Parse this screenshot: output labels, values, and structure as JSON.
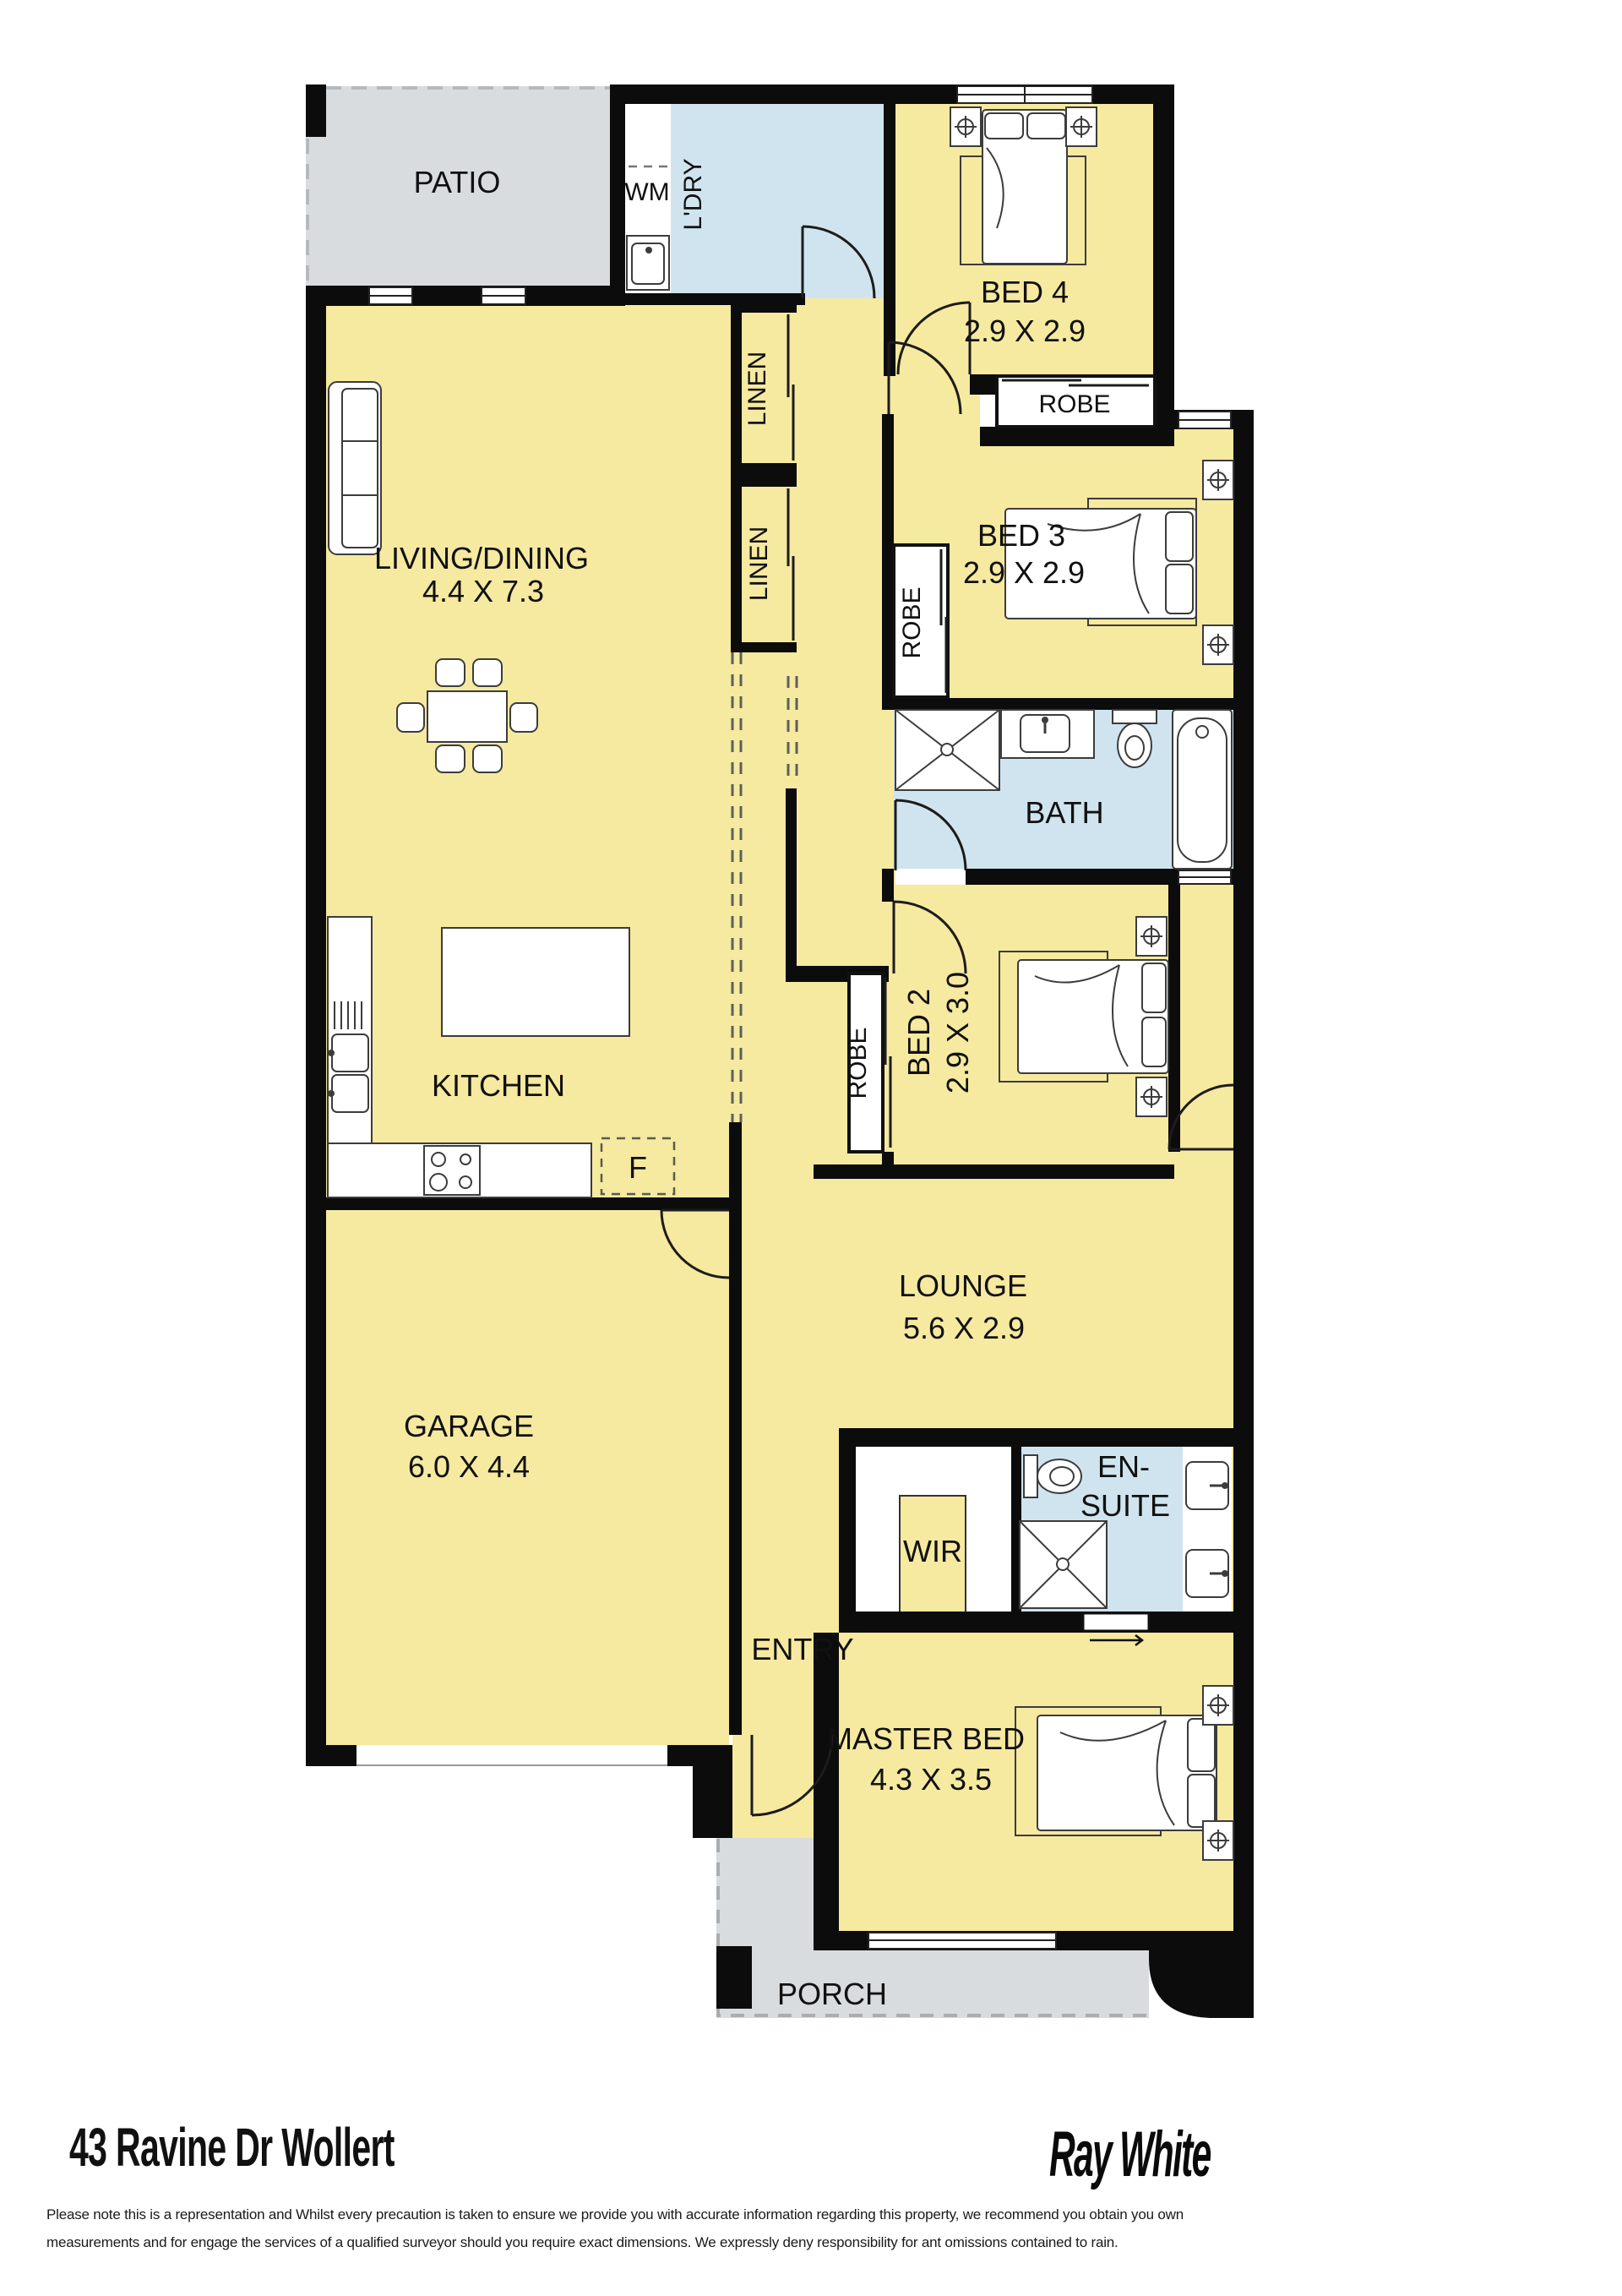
{
  "rooms": {
    "patio": {
      "label": "PATIO"
    },
    "laundry": {
      "name": "L'DRY",
      "wm_label": "WM"
    },
    "bed4": {
      "name": "BED 4",
      "size": "2.9 X 2.9"
    },
    "robe_bed4": {
      "label": "ROBE"
    },
    "linen_top": {
      "label": "LINEN"
    },
    "linen_bottom": {
      "label": "LINEN"
    },
    "bed3": {
      "name": "BED 3",
      "size": "2.9 X 2.9"
    },
    "robe_bed3": {
      "label": "ROBE"
    },
    "bath": {
      "name": "BATH"
    },
    "bed2": {
      "name": "BED 2",
      "size": "2.9 X 3.0"
    },
    "robe_bed2": {
      "label": "ROBE"
    },
    "living": {
      "name": "LIVING/DINING",
      "size": "4.4 X 7.3"
    },
    "kitchen": {
      "name": "KITCHEN",
      "fridge_label": "F"
    },
    "lounge": {
      "name": "LOUNGE",
      "size": "5.6 X 2.9"
    },
    "garage": {
      "name": "GARAGE",
      "size": "6.0 X 4.4"
    },
    "wir": {
      "label": "WIR"
    },
    "ensuite": {
      "line1": "EN-",
      "line2": "SUITE"
    },
    "entry": {
      "label": "ENTRY"
    },
    "master": {
      "name": "MASTER BED",
      "size": "4.3 X 3.5"
    },
    "porch": {
      "label": "PORCH"
    }
  },
  "footer": {
    "address": "43 Ravine Dr Wollert",
    "brand": "Ray White",
    "disclaimer_line1": "Please note this is a representation and Whilst every precaution is taken to ensure we provide you with accurate information regarding this property, we recommend you obtain you own",
    "disclaimer_line2": "measurements and for engage the services of a qualified surveyor should you require exact dimensions. We expressly deny responsibility  for ant omissions contained to rain."
  },
  "colors": {
    "interior_fill": "#f6e9a0",
    "outdoor_fill": "#d8dcde",
    "wet_area_fill": "#cfe4ee",
    "wall": "#0c0c0c",
    "text": "#111111"
  }
}
